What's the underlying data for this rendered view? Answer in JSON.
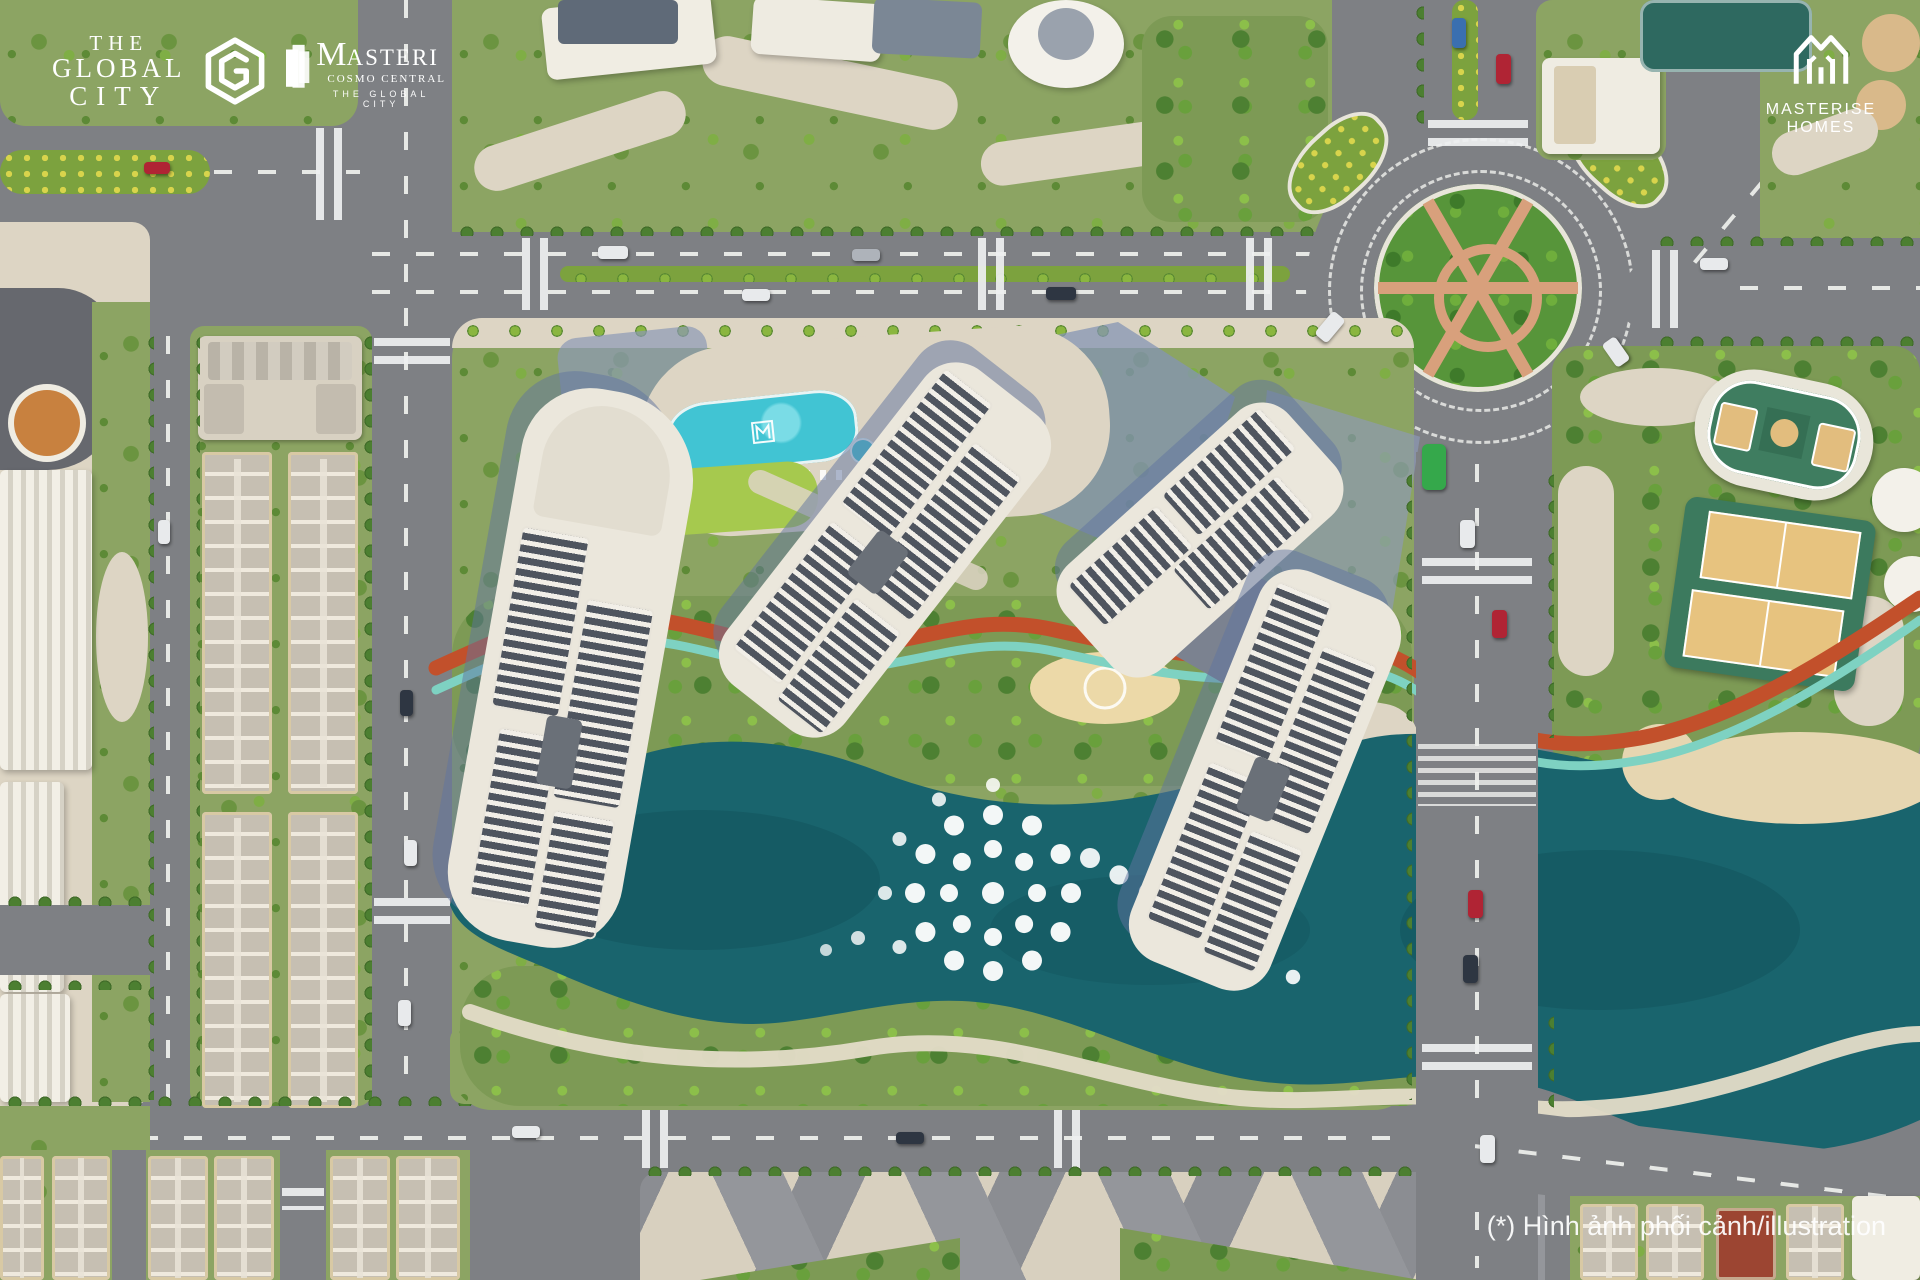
{
  "branding": {
    "the_global_city": {
      "line1": "THE",
      "line2": "GLOBAL",
      "line3": "CITY"
    },
    "masteri": {
      "initial": "M",
      "rest": "ASTERI",
      "subtitle": "COSMO CENTRAL",
      "tagline": "THE GLOBAL CITY"
    },
    "masterise_homes": {
      "name": "MASTERISE HOMES"
    }
  },
  "disclaimer": {
    "text": "(*) Hình ảnh phối cảnh/illustration"
  },
  "scene": {
    "type": "aerial-masterplan-render",
    "palette": {
      "road": "#7e8084",
      "sidewalk": "#ddd5c4",
      "park_green": "#8ca463",
      "lawn_green": "#a6c94e",
      "tree_dark": "#4c7f31",
      "lake_teal": "#19646d",
      "pool_turquoise": "#41c4d3",
      "jogging_path_orange": "#c2502b",
      "cycle_path_teal": "#7ed2c2",
      "tower_roof_white": "#ebe7dc",
      "roof_panel_dark": "#4f555f",
      "building_shadow_blue": "#6073a0",
      "townhouse_roof": "#c6bfb2",
      "court_green": "#3f7d60",
      "court_tan": "#e2bd7e",
      "roundabout_green": "#57953a",
      "roundabout_path_tan": "#d8a07c",
      "amphitheater_orange": "#c8813f",
      "bus_green": "#35a84b"
    }
  }
}
